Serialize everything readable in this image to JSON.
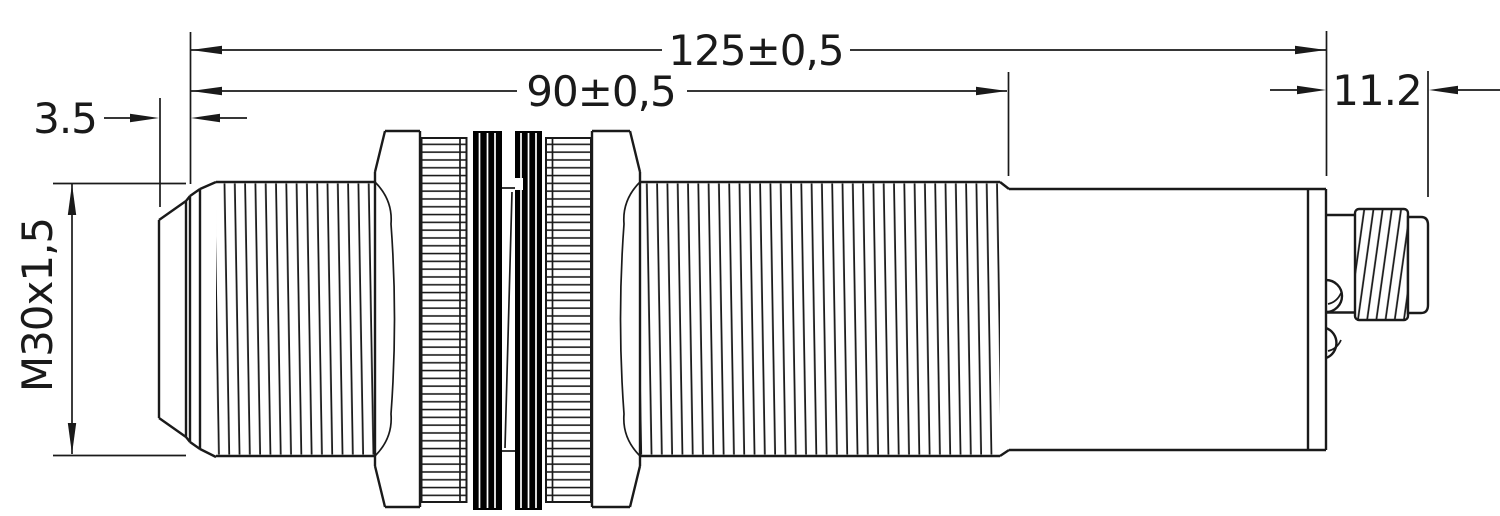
{
  "drawing": {
    "dimensions": {
      "overall_length": {
        "label": "125±0,5",
        "value_mm": 125,
        "tolerance_mm": 0.5
      },
      "thread_length": {
        "label": "90±0,5",
        "value_mm": 90,
        "tolerance_mm": 0.5
      },
      "tip_length": {
        "label": "3.5",
        "value_mm": 3.5
      },
      "connector_length": {
        "label": "11.2",
        "value_mm": 11.2
      },
      "thread_spec": {
        "label": "M30x1,5"
      }
    },
    "colors": {
      "line": "#1a1a1a",
      "background": "#ffffff",
      "seal": "#000000"
    }
  }
}
